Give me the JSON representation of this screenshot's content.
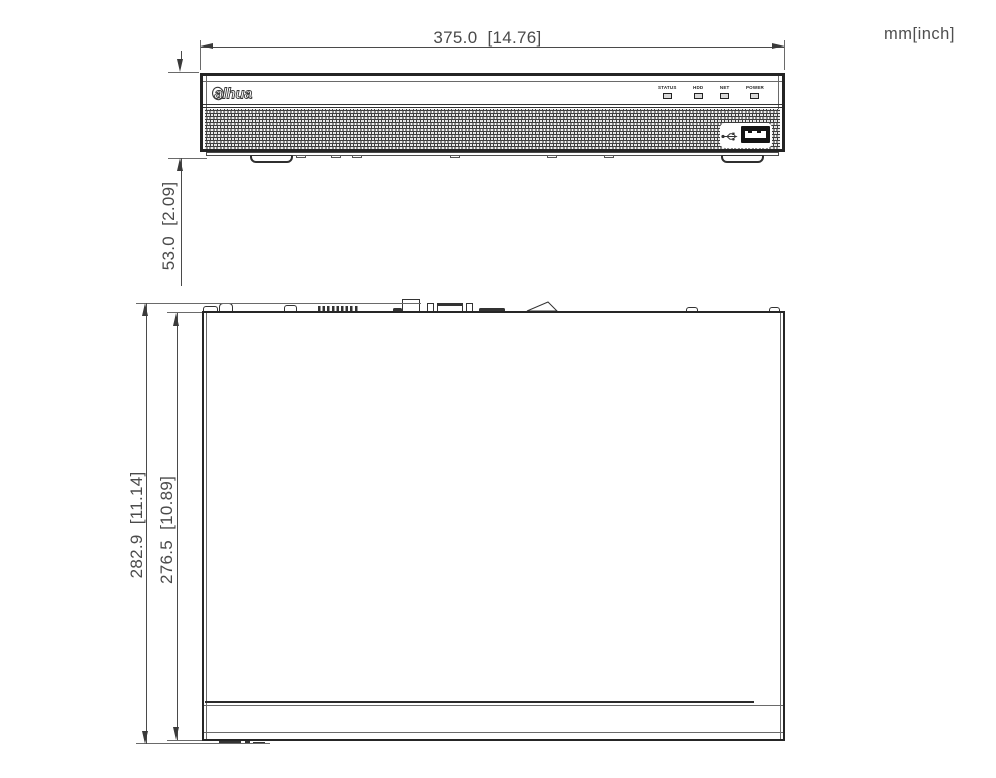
{
  "units_note": "mm[inch]",
  "front_view": {
    "width_dim": "375.0  [14.76]",
    "height_dim": "53.0  [2.09]",
    "logo_text": "alhua",
    "indicators": [
      "STATUS",
      "HDD",
      "NET",
      "POWER"
    ],
    "icons": {
      "usb": "usb-trident-icon"
    },
    "colors": {
      "line": "#3a3a3a",
      "text": "#4a4a4a",
      "port_fill": "#141414"
    }
  },
  "top_view": {
    "depth_overall_dim": "282.9  [11.14]",
    "depth_body_dim": "276.5  [10.89]"
  }
}
